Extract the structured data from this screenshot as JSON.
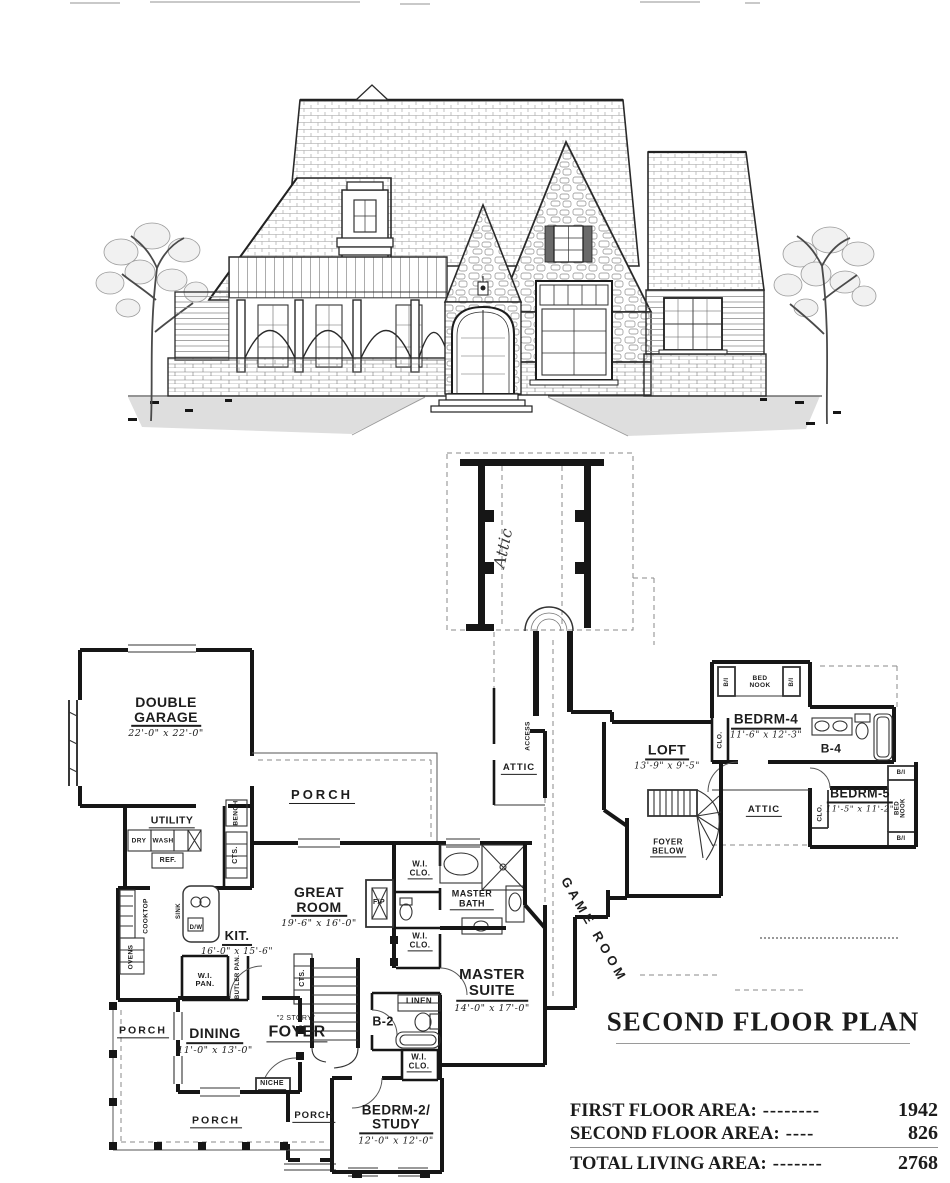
{
  "attic_plan": {
    "attic_handwritten": "Attic"
  },
  "first_floor": {
    "garage": {
      "name": "DOUBLE\nGARAGE",
      "dims": "22'-0\" x 22'-0\""
    },
    "utility": "UTILITY",
    "dry": "DRY",
    "wash": "WASH",
    "ref": "REF.",
    "bench": "BENCH",
    "cts_mud": "CTS.",
    "porch_top": "PORCH",
    "cooktop": "COOKTOP",
    "ovens": "OVENS",
    "sink": "SINK",
    "dw": "D/W",
    "kitchen": {
      "name": "KIT.",
      "dims": "16'-0\" x 15'-6\""
    },
    "wi_pan": "W.I.\nPAN.",
    "butler_pan": "BUTLER PAN.",
    "cts_stair": "CTS.",
    "great_room": {
      "name": "GREAT\nROOM",
      "dims": "19'-6\" x 16'-0\""
    },
    "fireplace": "F/P",
    "wi_clo_bath_upper": "W.I.\nCLO.",
    "wi_clo_bath_lower": "W.I.\nCLO.",
    "master_bath": "MASTER\nBATH",
    "master_suite": {
      "name": "MASTER\nSUITE",
      "dims": "14'-0\" x 17'-0\""
    },
    "linen": "LINEN",
    "bath2": "B-2",
    "wi_clo_bedrm2": "W.I.\nCLO.",
    "two_story": "\"2 STORY\"",
    "foyer": "FOYER",
    "niche": "NICHE",
    "dining": {
      "name": "DINING",
      "dims": "11'-0\" x 13'-0\""
    },
    "bedrm2": {
      "name": "BEDRM-2/\nSTUDY",
      "dims": "12'-0\" x 12'-0\""
    },
    "porch_left": "PORCH",
    "porch_bottom": "PORCH",
    "porch_entry": "PORCH"
  },
  "second_floor": {
    "access": "ACCESS",
    "attic_left": "ATTIC",
    "loft": {
      "name": "LOFT",
      "dims": "13'-9\" x 9'-5\""
    },
    "game_room": "GAME ROOM",
    "foyer_below": "FOYER\nBELOW",
    "clo_hall": "CLO.",
    "bi_left": "B/I",
    "bed_nook_top": "BED\nNOOK",
    "bi_right": "B/I",
    "bedrm4": {
      "name": "BEDRM-4",
      "dims": "11'-6\" x 12'-3\""
    },
    "bath4": "B-4",
    "attic_right": "ATTIC",
    "bedrm5": {
      "name": "BEDRM-5",
      "dims": "11'-5\" x 11'-2\""
    },
    "clo_bedrm5": "CLO.",
    "bed_nook_right": "BED\nNOOK",
    "bi_nook_top": "B/I",
    "bi_nook_bottom": "B/I"
  },
  "titles": {
    "second_floor_plan": "SECOND FLOOR PLAN"
  },
  "area_table": {
    "rows": [
      {
        "label": "FIRST FLOOR AREA:",
        "dashes": "--------",
        "value": "1942"
      },
      {
        "label": "SECOND FLOOR AREA:",
        "dashes": "----",
        "value": "826"
      },
      {
        "label": "TOTAL LIVING AREA:",
        "dashes": "-------",
        "value": "2768"
      }
    ]
  }
}
